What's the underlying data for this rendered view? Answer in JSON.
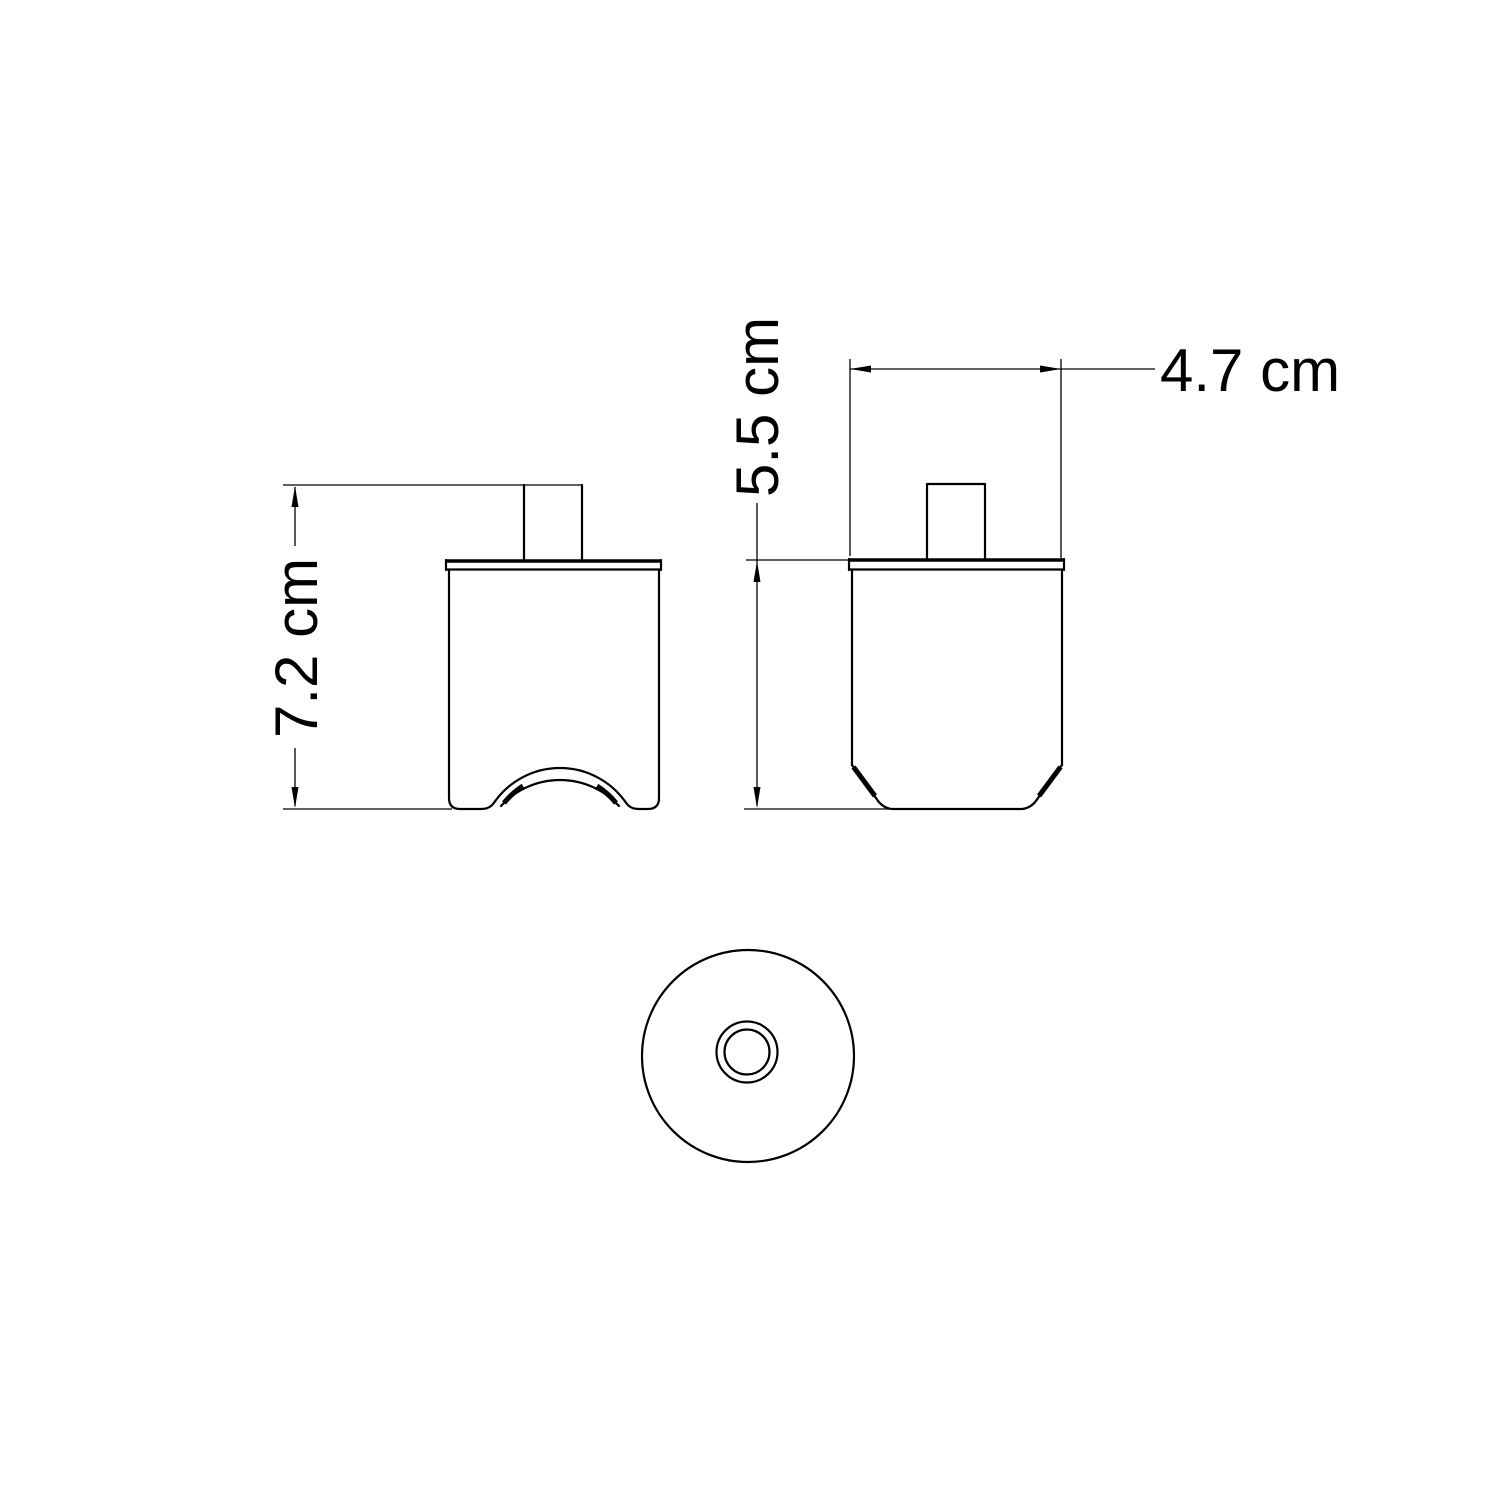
{
  "canvas": {
    "background": "#ffffff",
    "line_color": "#000000"
  },
  "dimensions": {
    "total_height": {
      "label": "7.2 cm",
      "value": 7.2,
      "unit": "cm"
    },
    "body_height": {
      "label": "5.5 cm",
      "value": 5.5,
      "unit": "cm"
    },
    "body_width": {
      "label": "4.7 cm",
      "value": 4.7,
      "unit": "cm"
    }
  }
}
